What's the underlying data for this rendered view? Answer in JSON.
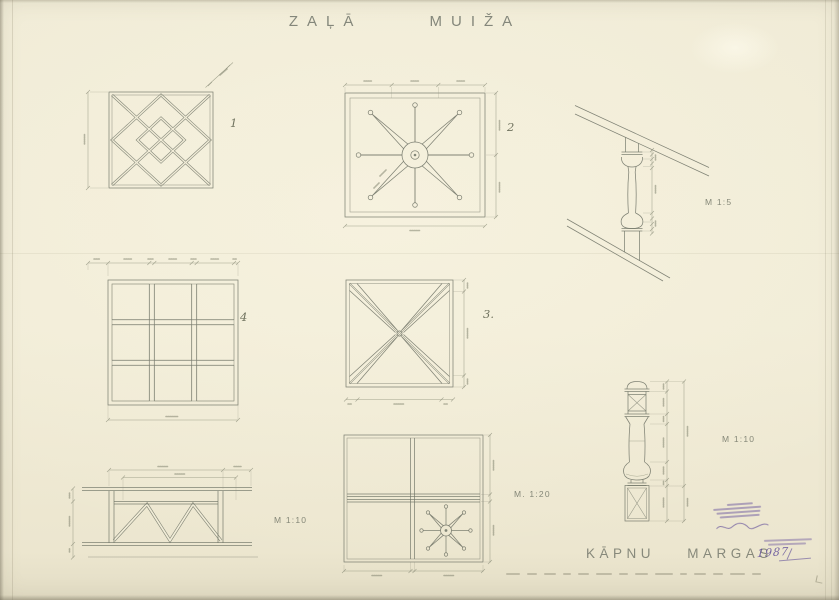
{
  "sheet": {
    "title": "ZAĻĀ MUIŽA",
    "subtitle": "KĀPNU MARGAS"
  },
  "panels": {
    "p1": "1",
    "p2": "2",
    "p3": "3.",
    "p4": "4"
  },
  "scales": {
    "baluster": "M 1:5",
    "elevation": "M 1:10",
    "grid": "M. 1:20",
    "newel": "M 1:10"
  },
  "stamp": {
    "handwriting": "1987"
  }
}
